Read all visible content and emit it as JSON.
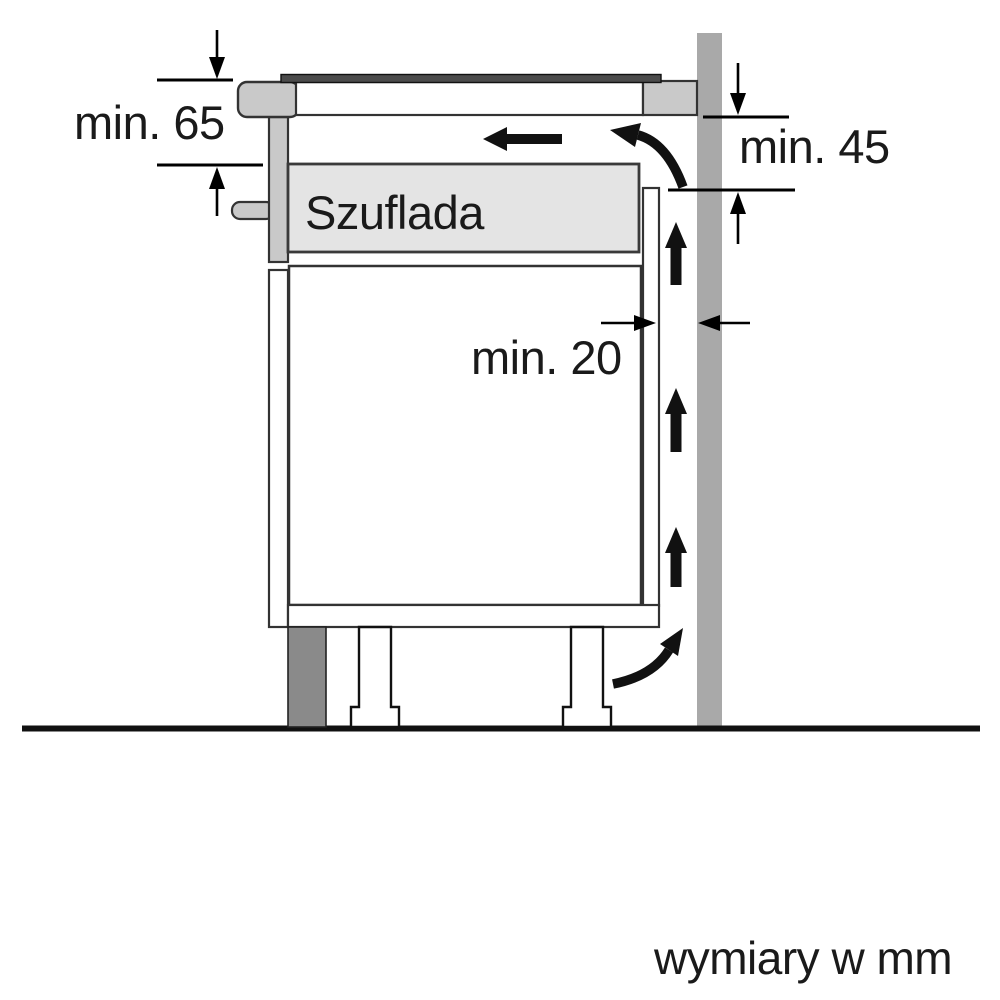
{
  "labels": {
    "min_65": "min. 65",
    "min_45": "min. 45",
    "min_20": "min. 20",
    "drawer": "Szuflada",
    "units_caption": "wymiary w mm"
  },
  "dimensions_mm": {
    "clearance_below_worktop": "min. 65",
    "clearance_behind_hob": "min. 45",
    "wall_air_gap": "min. 20"
  },
  "colors": {
    "background": "#ffffff",
    "line_black": "#111111",
    "structure_stroke": "#333333",
    "light_gray": "#c9c9c9",
    "drawer_fill": "#e4e4e4",
    "wall_gray": "#a9a9a9",
    "plinth_gray": "#8a8a8a",
    "hob_glass": "#4b4b4b"
  }
}
